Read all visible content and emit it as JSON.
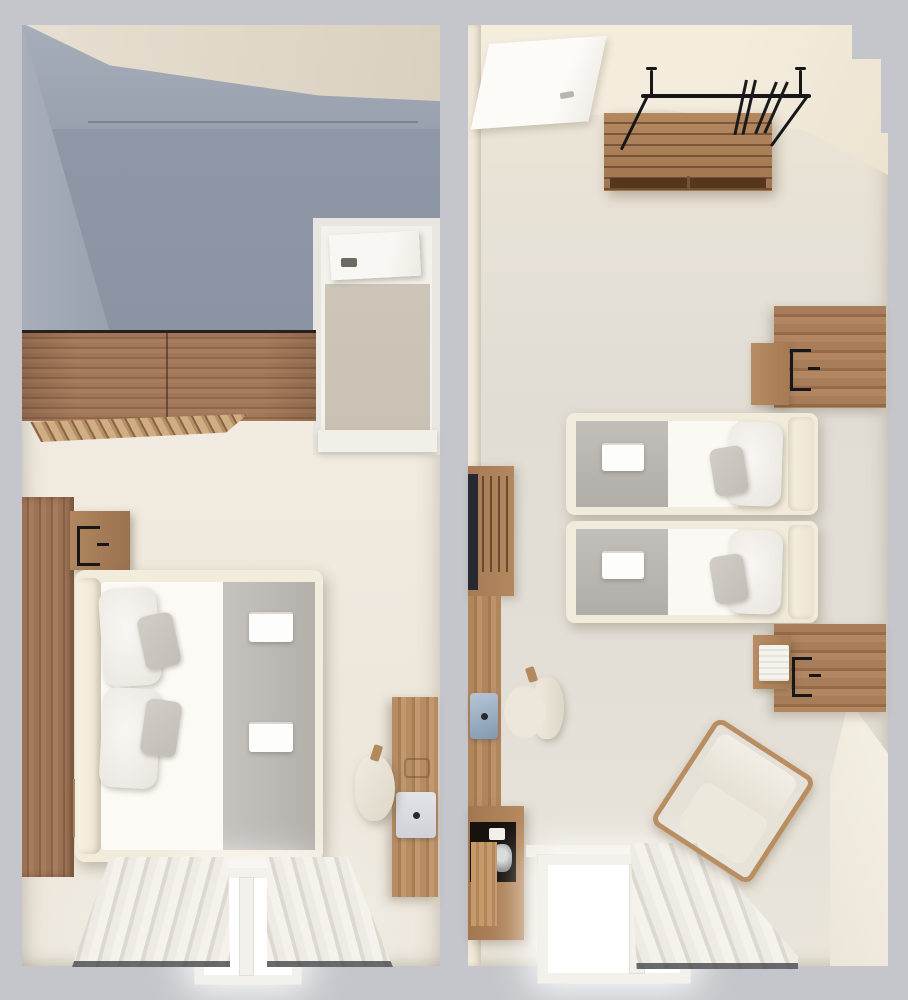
{
  "scene": {
    "title": "3d-top-down-floor-plan-two-hotel-rooms",
    "left_unit": {
      "name": "double-room-with-terrace",
      "areas": [
        "shaded-terrace",
        "bathroom",
        "bedroom"
      ],
      "furniture": [
        "wardrobe",
        "slatted-shelf",
        "wood-headboard-wall",
        "nightstand-top",
        "nightstand-bottom",
        "wall-lamp-top",
        "wall-lamp-bottom",
        "book",
        "double-bed",
        "bed-runner",
        "folded-towels",
        "pillows",
        "desk",
        "laptop",
        "desk-chair",
        "window",
        "curtains"
      ]
    },
    "right_unit": {
      "name": "twin-room",
      "areas": [
        "entry",
        "bedroom"
      ],
      "furniture": [
        "entry-door",
        "luggage-bench",
        "clothes-rack",
        "hangers",
        "twin-bed-top",
        "twin-bed-bottom",
        "headboard-panel-top",
        "headboard-panel-bottom",
        "wall-lamps",
        "wall-shelves",
        "book",
        "media-cabinet",
        "tv",
        "desk",
        "laptop",
        "desk-chair",
        "minibar",
        "coffee-machine",
        "armchair",
        "window",
        "curtain"
      ]
    }
  },
  "palette": {
    "bg": "#c5c6cb",
    "divider": "#bcbfc6",
    "dark_floor": "#8b94a3",
    "dark_wall": "#a6aeba",
    "lit": "#e7dfd1",
    "cream_floor": "#efe9de",
    "right_floor": "#e2ded6",
    "right_wall": "#f4edde",
    "wood": "#a1765a",
    "wood_dark": "#7c5740",
    "wood_light": "#c3a077",
    "frame": "#f2ecdd",
    "mattress": "#fbfaf5",
    "blanket": "#bab5b1",
    "cushion": "#cac5c0",
    "metal": "#17171a",
    "glow": "#ffffff",
    "bath_floor": "#c9c2b4",
    "curtain": "#f0ede6"
  }
}
